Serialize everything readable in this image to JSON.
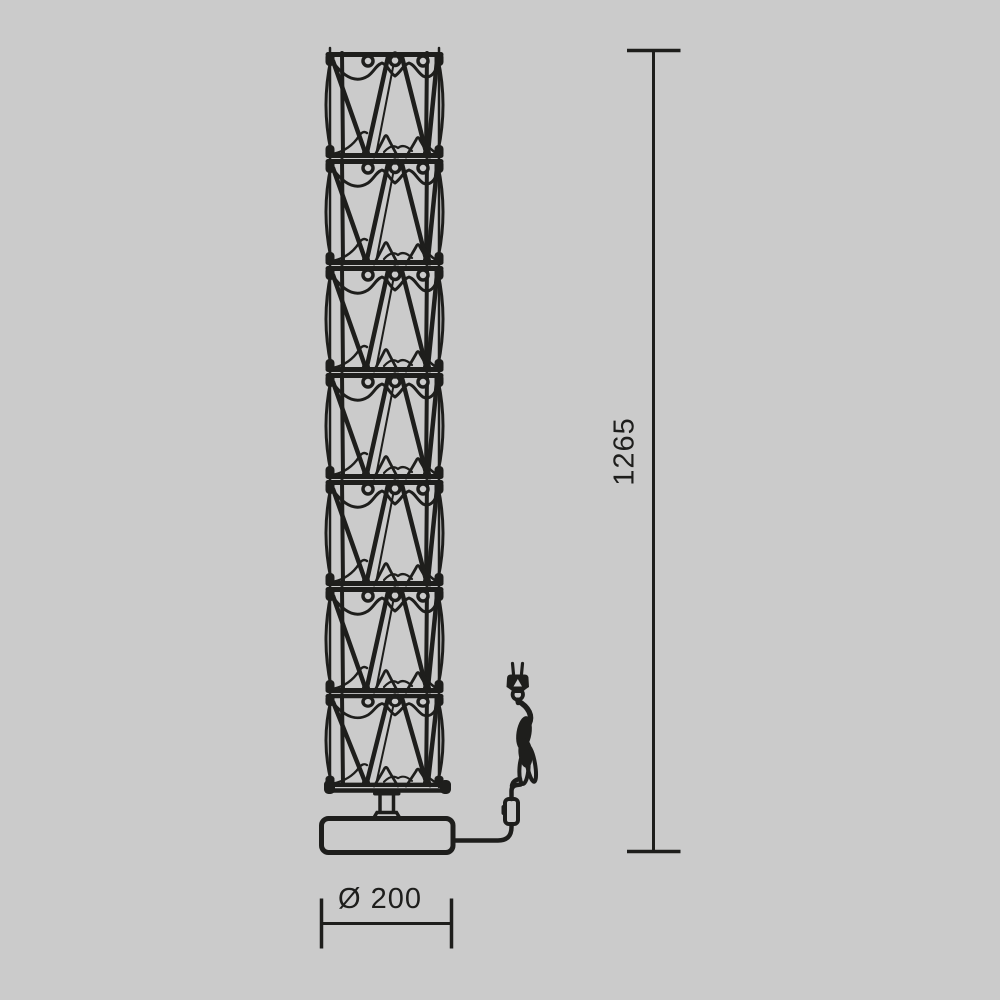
{
  "colors": {
    "background": "#cbcbcb",
    "ink": "#1e1e1c"
  },
  "lamp": {
    "module_count": 7
  },
  "dimensions": {
    "height": {
      "label": "1265"
    },
    "base_diameter": {
      "label": "Ø 200"
    }
  }
}
